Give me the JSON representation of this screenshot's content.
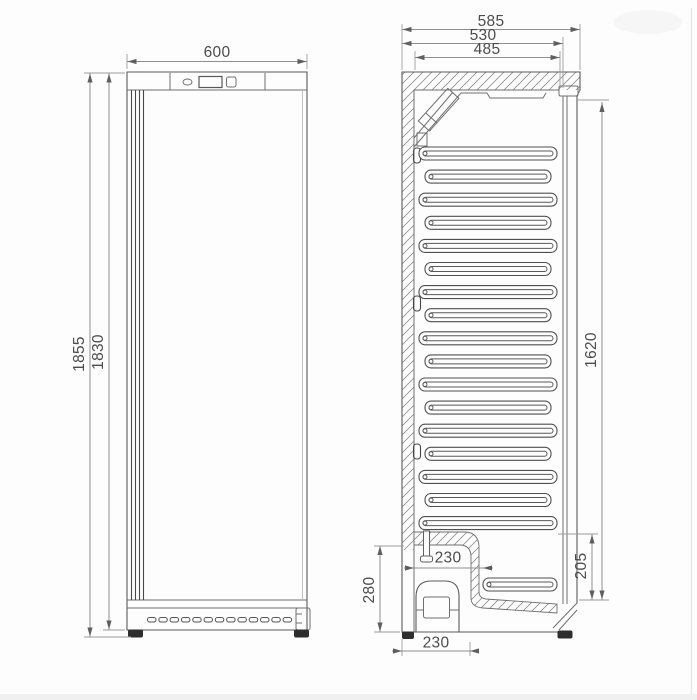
{
  "diagram": {
    "type": "technical dimension drawing",
    "subject": "Upright refrigerator cabinet - front view and side section view",
    "units": "mm",
    "front_view": {
      "label": "front view",
      "width": "600",
      "overall_height": "1855",
      "body_height": "1830"
    },
    "side_view": {
      "label": "side section view",
      "overall_depth": "585",
      "body_depth": "530",
      "interior_depth": "485",
      "interior_height": "1620",
      "front_base_height": "205",
      "compressor_compartment_height": "280",
      "compressor_recess_depth": "230",
      "compressor_base_depth": "230"
    },
    "structure": {
      "shelf_rows": 17,
      "bottom_shelf_rows": 1,
      "vent_slots": 13
    }
  }
}
